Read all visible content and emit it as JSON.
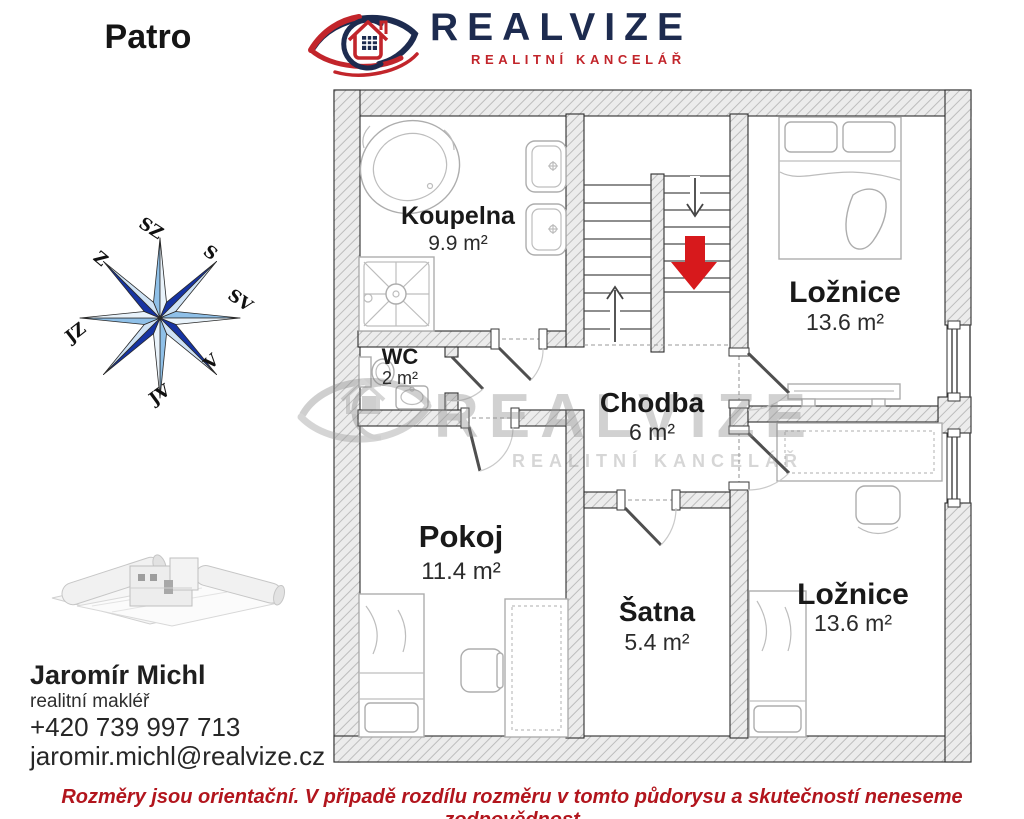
{
  "header": {
    "floor_label": "Patro",
    "brand": "REALVIZE",
    "tagline": "REALITNÍ KANCELÁŘ"
  },
  "compass": {
    "labels": [
      "SZ",
      "S",
      "SV",
      "V",
      "JV",
      "JZ",
      "Z"
    ]
  },
  "floorplan": {
    "rooms": [
      {
        "name": "Koupelna",
        "area": "9.9 m²"
      },
      {
        "name": "WC",
        "area": "2 m²"
      },
      {
        "name": "Ložnice",
        "area": "13.6 m²"
      },
      {
        "name": "Chodba",
        "area": "6 m²"
      },
      {
        "name": "Pokoj",
        "area": "11.4 m²"
      },
      {
        "name": "Šatna",
        "area": "5.4 m²"
      },
      {
        "name": "Ložnice",
        "area": "13.6 m²"
      }
    ]
  },
  "watermark": {
    "brand": "REALVIZE",
    "tagline": "REALITNÍ KANCELÁŘ"
  },
  "agent": {
    "name": "Jaromír Michl",
    "role": "realitní makléř",
    "phone": "+420 739 997 713",
    "email": "jaromir.michl@realvize.cz"
  },
  "footer": {
    "disclaimer": "Rozměry jsou orientační. V připadě rozdílu rozměru v tomto půdorysu a skutečností neneseme zodpovědnost"
  },
  "colors": {
    "brand_navy": "#1d2b4f",
    "brand_red": "#c2252b",
    "arrow_red": "#d7191c",
    "disclaimer_red": "#b2151d",
    "compass_dark": "#1634a3",
    "compass_light": "#8fc0e8"
  }
}
